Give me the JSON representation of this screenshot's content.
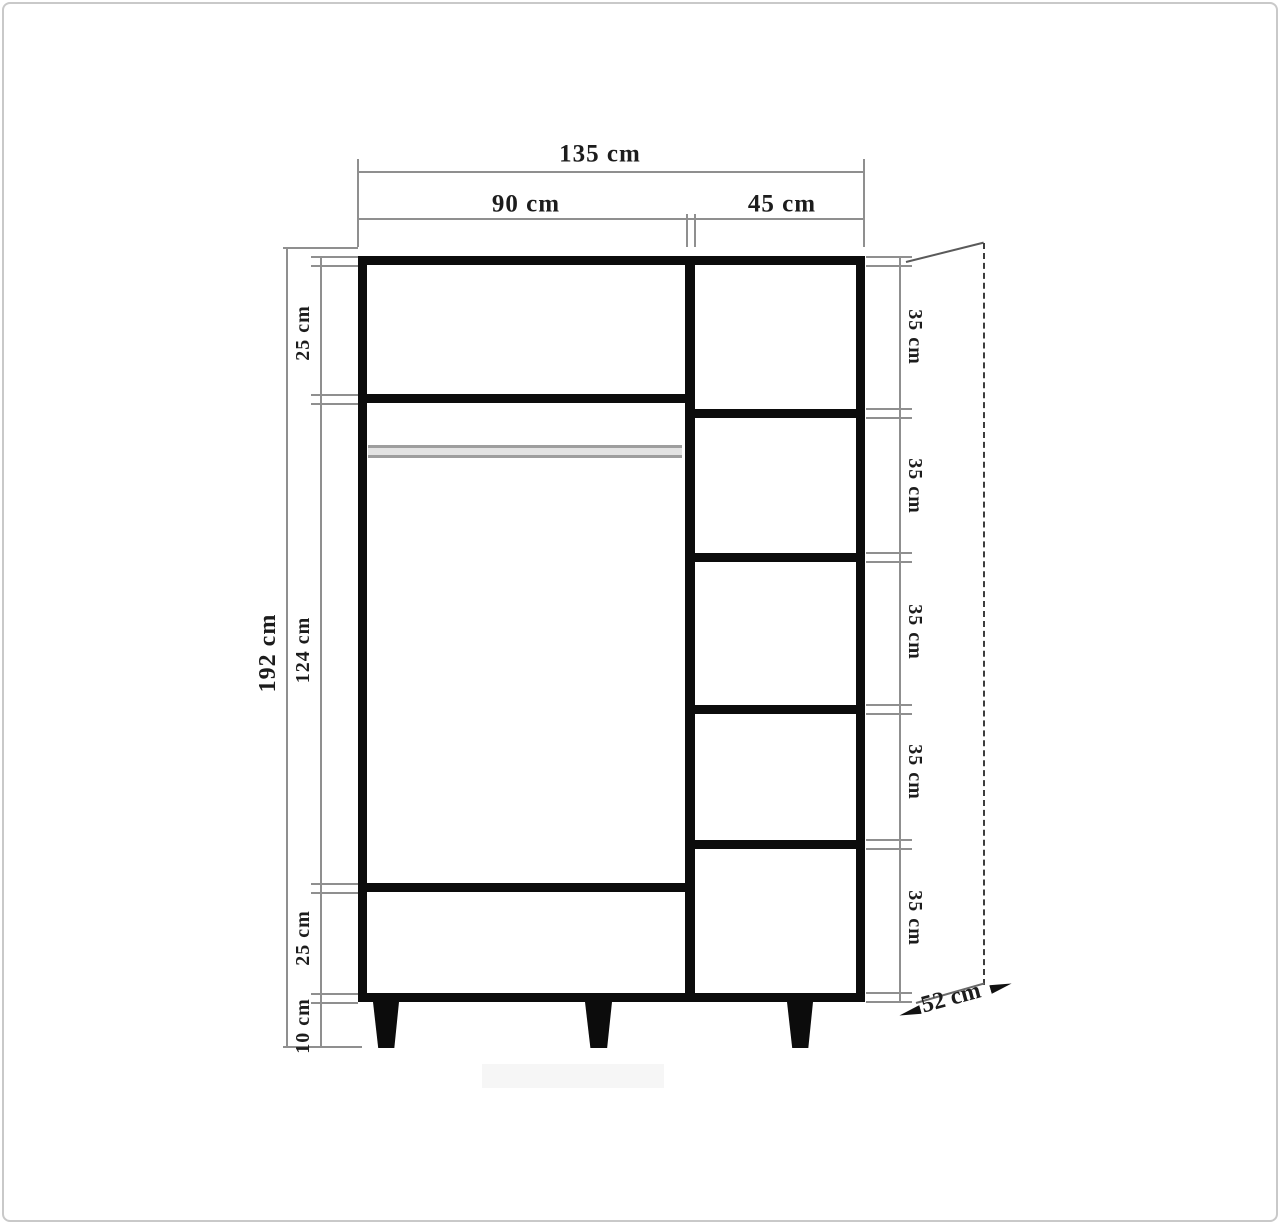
{
  "diagram": {
    "description": "Wardrobe front-view dimensional drawing",
    "top_dimensions": {
      "total_width": "135 cm",
      "left_section_width": "90 cm",
      "right_section_width": "45 cm"
    },
    "left_dimensions": {
      "total_height": "192 cm",
      "top_compartment": "25 cm",
      "middle_section": "124 cm",
      "bottom_compartment": "25 cm",
      "leg_height": "10 cm"
    },
    "right_dimensions": {
      "shelf_labels": [
        "35 cm",
        "35 cm",
        "35 cm",
        "35 cm",
        "35 cm"
      ]
    },
    "depth_dimension": {
      "label": "52 cm"
    },
    "colors": {
      "structure": "#0c0c0c",
      "dimension_line": "#8f8f8f",
      "rod": "#9e9e9e",
      "background": "#ffffff",
      "frame": "#c9c9c9"
    }
  }
}
